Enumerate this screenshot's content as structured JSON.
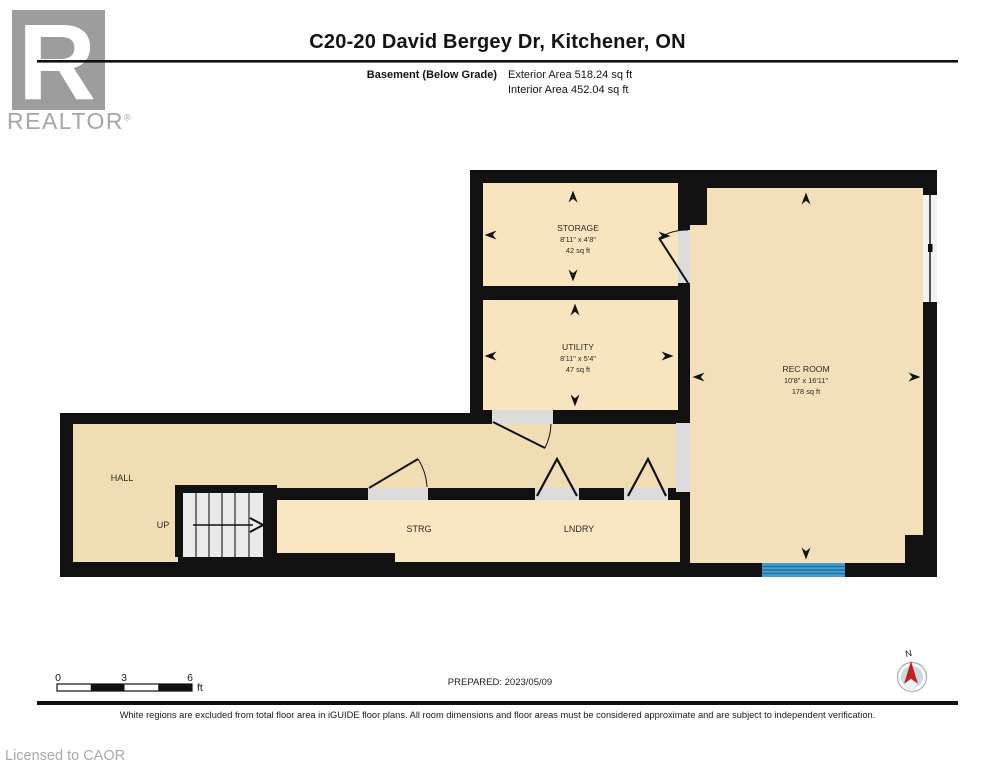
{
  "header": {
    "title": "C20-20 David Bergey Dr, Kitchener, ON",
    "floor_label": "Basement (Below Grade)",
    "exterior_area": "Exterior Area 518.24 sq ft",
    "interior_area": "Interior Area 452.04 sq ft"
  },
  "branding": {
    "logo_letter": "R",
    "logo_text": "REALTOR",
    "logo_reg": "®",
    "licensed_to": "Licensed to CAOR"
  },
  "rooms": {
    "storage": {
      "name": "STORAGE",
      "dims": "8'11\" x 4'8\"",
      "area": "42 sq ft"
    },
    "utility": {
      "name": "UTILITY",
      "dims": "8'11\" x 5'4\"",
      "area": "47 sq ft"
    },
    "rec_room": {
      "name": "REC ROOM",
      "dims": "10'8\" x 16'11\"",
      "area": "178 sq ft"
    },
    "hall": {
      "name": "HALL"
    },
    "strg": {
      "name": "STRG"
    },
    "lndry": {
      "name": "LNDRY"
    },
    "stairs": {
      "label": "UP"
    }
  },
  "scale_bar": {
    "tick0": "0",
    "tick1": "3",
    "tick2": "6",
    "unit": "ft"
  },
  "compass": {
    "north_label": "N"
  },
  "footer": {
    "prepared": "PREPARED: 2023/05/09",
    "disclaimer": "White regions are excluded from total floor area in iGUIDE floor plans. All room dimensions and floor areas must be considered approximate and are subject to independent verification."
  },
  "colors": {
    "wall": "#111111",
    "floor_tan": "#f8e5c0",
    "hall_tan": "#f1ddb4",
    "strg_tan": "#f9e6c3",
    "rec_tan": "#f3e0ba",
    "door_sill": "#dcdcdc",
    "slider_blue": "#44a0d2",
    "compass_red": "#c22222",
    "logo_gray": "#9d9d9d"
  }
}
